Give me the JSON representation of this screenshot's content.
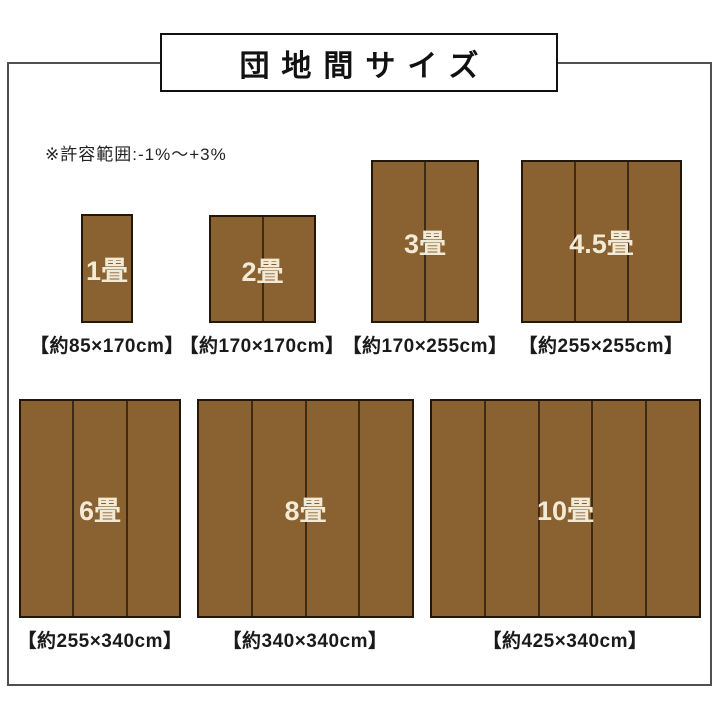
{
  "title": "団地間サイズ",
  "note": "※許容範囲:-1%〜+3%",
  "colors": {
    "mat_fill": "#8a6232",
    "mat_divider": "#3f2b15",
    "mat_border": "#241708",
    "mat_label": "#f3ead6",
    "frame_border": "#4f4f4f",
    "title_box_border": "#111111",
    "caption_text": "#1a1a1a"
  },
  "mats": [
    {
      "label": "1畳",
      "caption": "【約85×170cm】",
      "panels": 1
    },
    {
      "label": "2畳",
      "caption": "【約170×170cm】",
      "panels": 2
    },
    {
      "label": "3畳",
      "caption": "【約170×255cm】",
      "panels": 2
    },
    {
      "label": "4.5畳",
      "caption": "【約255×255cm】",
      "panels": 3
    },
    {
      "label": "6畳",
      "caption": "【約255×340cm】",
      "panels": 3
    },
    {
      "label": "8畳",
      "caption": "【約340×340cm】",
      "panels": 4
    },
    {
      "label": "10畳",
      "caption": "【約425×340cm】",
      "panels": 5
    }
  ]
}
